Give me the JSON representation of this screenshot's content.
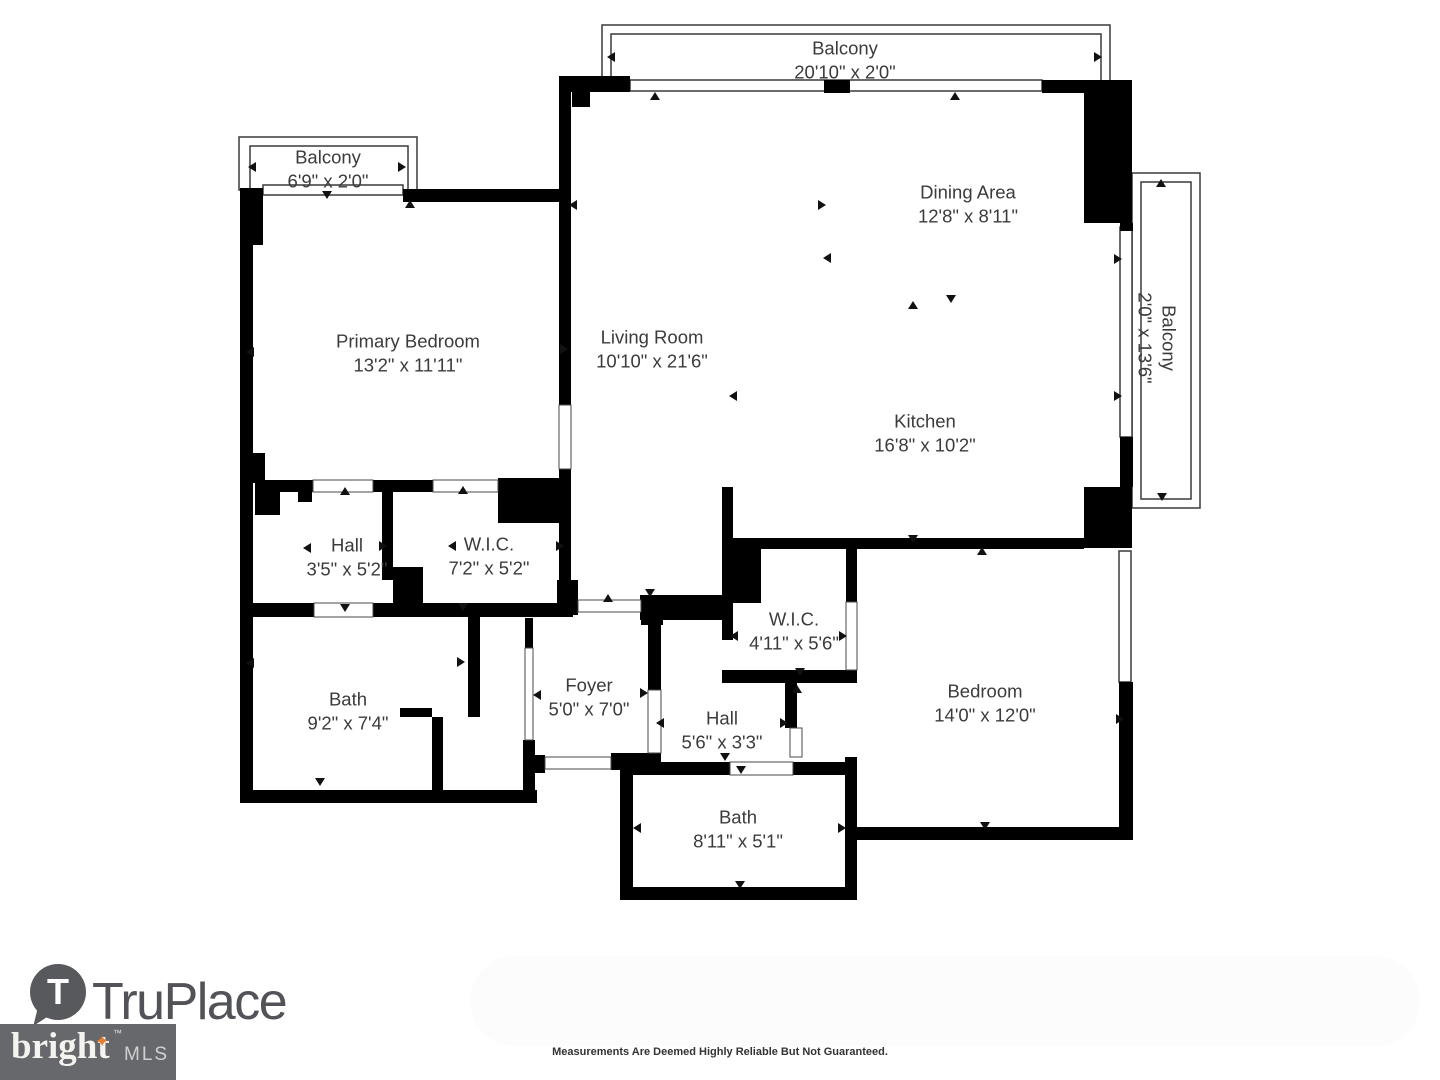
{
  "rooms": [
    {
      "id": "balcony-top",
      "name": "Balcony",
      "dims": "20'10\" x 2'0\""
    },
    {
      "id": "balcony-left",
      "name": "Balcony",
      "dims": "6'9\" x 2'0\""
    },
    {
      "id": "balcony-right",
      "name": "Balcony",
      "dims": "2'0\" x 13'6\""
    },
    {
      "id": "primary-bedroom",
      "name": "Primary Bedroom",
      "dims": "13'2\" x 11'11\""
    },
    {
      "id": "living-room",
      "name": "Living Room",
      "dims": "10'10\" x 21'6\""
    },
    {
      "id": "dining-area",
      "name": "Dining Area",
      "dims": "12'8\" x 8'11\""
    },
    {
      "id": "kitchen",
      "name": "Kitchen",
      "dims": "16'8\" x 10'2\""
    },
    {
      "id": "hall-upper",
      "name": "Hall",
      "dims": "3'5\" x 5'2\""
    },
    {
      "id": "wic-upper",
      "name": "W.I.C.",
      "dims": "7'2\" x 5'2\""
    },
    {
      "id": "bath-upper",
      "name": "Bath",
      "dims": "9'2\" x 7'4\""
    },
    {
      "id": "foyer",
      "name": "Foyer",
      "dims": "5'0\" x 7'0\""
    },
    {
      "id": "wic-lower",
      "name": "W.I.C.",
      "dims": "4'11\" x 5'6\""
    },
    {
      "id": "hall-lower",
      "name": "Hall",
      "dims": "5'6\" x 3'3\""
    },
    {
      "id": "bath-lower",
      "name": "Bath",
      "dims": "8'11\" x 5'1\""
    },
    {
      "id": "bedroom",
      "name": "Bedroom",
      "dims": "14'0\" x 12'0\""
    }
  ],
  "footer": {
    "truplace_wordmark": "TruPlace",
    "truplace_pin_letter": "T",
    "bright_wordmark": "bright",
    "bright_star": "✦",
    "bright_trademark": "™",
    "bright_mls": "MLS",
    "disclaimer": "Measurements Are Deemed Highly Reliable But Not Guaranteed."
  },
  "colors": {
    "wall": "#000000",
    "thin_line": "#3a3a3a",
    "label_text": "#3b3b3b",
    "truplace_gray": "#525358",
    "bright_box_gray": "#67686b",
    "bright_star_orange": "#e87b2c",
    "mls_text": "#cfd0d2"
  }
}
